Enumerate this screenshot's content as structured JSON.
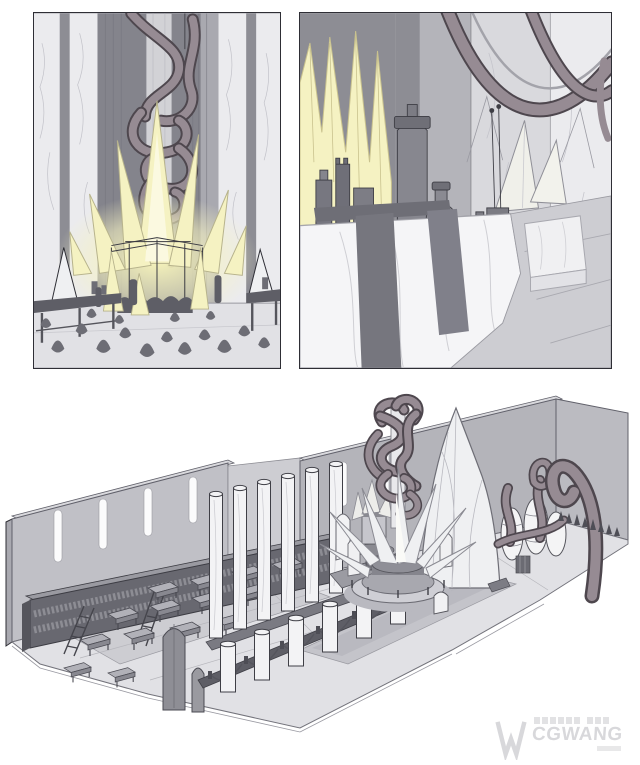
{
  "palette": {
    "background": "#ffffff",
    "ink": "#2e2e35",
    "wall_light": "#ebebee",
    "wall_mid": "#a9a9b0",
    "wall_dark": "#8d8d94",
    "wall_deep": "#84848c",
    "backwall": "#b4b4ba",
    "floor_light": "#e1e1e5",
    "floor_mid": "#cdcdd2",
    "carpet": "#c4c4ca",
    "furniture_dark": "#5e5e66",
    "bookshelf": "#686870",
    "column_white": "#f3f3f5",
    "crystal_white": "#eff0f2",
    "crystal_glow": "#f5f2c2",
    "crystal_glow_deep": "#ece793",
    "tentacle": "#968b93",
    "tentacle_outline": "#4e474e",
    "blob": "#6d6d75",
    "watermark": "#d8d8db"
  },
  "scenes": {
    "altar_closeup": {
      "label": "crystal-altar-hall-closeup-painting"
    },
    "lab_closeup": {
      "label": "crystal-lab-table-closeup-painting"
    },
    "overview": {
      "label": "hall-layout-overview-sketch"
    }
  },
  "watermark": {
    "text": "CGWANG"
  }
}
